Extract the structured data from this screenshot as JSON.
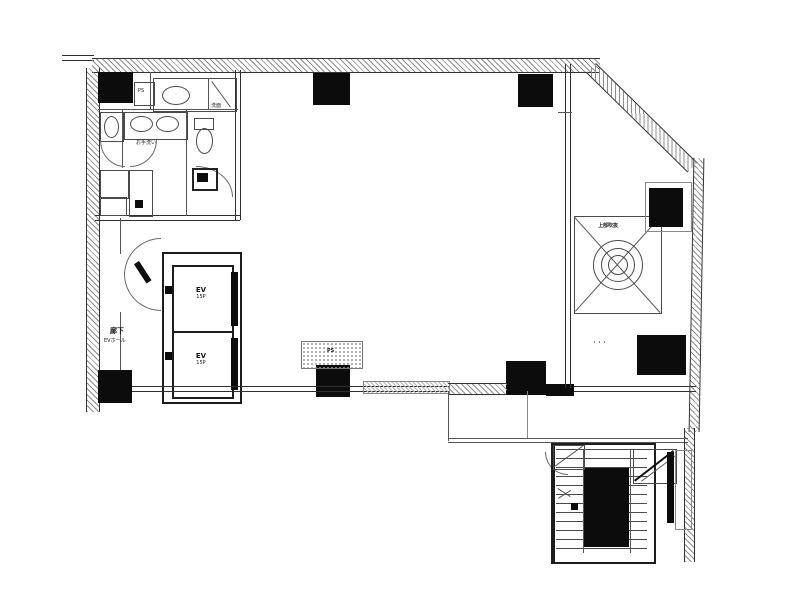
{
  "plan": {
    "background": "#ffffff",
    "line_color": "#2e2e2e",
    "column_fill": "#0c0c0c"
  },
  "labels": {
    "ps_shaft_top": "PS",
    "ps_shaft_bottom": "PS",
    "washbasin": "洗面",
    "restroom": "お手洗い",
    "corridor": "廊下",
    "corridor_sub": "EVホール",
    "elevator_1": "EV",
    "elevator_1_capacity": "15P",
    "elevator_2": "EV",
    "elevator_2_capacity": "15P",
    "skylight": "上部吹抜",
    "annotation_dots": "・・・"
  }
}
